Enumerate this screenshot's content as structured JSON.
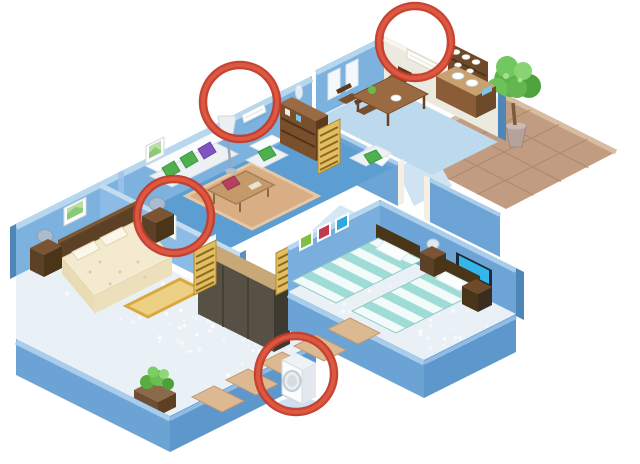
{
  "scene": {
    "type": "isometric-apartment-floorplan",
    "background": "#ffffff",
    "description_id": "aircon-placement-illustration"
  },
  "palette": {
    "wall_blue": "#7db2df",
    "wall_mid": "#6da4d6",
    "wall_shadow": "#5d97cb",
    "wall_top": "#b7d7ef",
    "wall_cap": "#4f86b8",
    "wall_cream": "#ece9df",
    "floor_living": "#5c9ed2",
    "floor_kitchen": "#bcd9ee",
    "floor_hall": "#cfe3f2",
    "carpet": "#e9f0f6",
    "terrace": "#c29c80",
    "terrace_line": "#a98566",
    "tile_path": "#dcb991",
    "wood_dark": "#5d4126",
    "wood_mid": "#8a5d38",
    "wood_tan": "#c9a878",
    "quilt_cream": "#f3ead0",
    "stripe_teal": "#9fdcd6",
    "stripe_white": "#f2fbfa",
    "cushion_green": "#4db14e",
    "cushion_purple": "#8055c1",
    "cushion_red": "#b5415f",
    "rug_yellow": "#edd083",
    "leaf_green": "#5cb34a",
    "ac_white": "#fdfefe"
  },
  "annotations": {
    "highlight_stroke_outer": "#c23b2a",
    "highlight_stroke_inner": "#e05a43",
    "circles": [
      {
        "id": "living-room-wall-ac",
        "cx": 240,
        "cy": 102,
        "r": 37
      },
      {
        "id": "kitchen-wall-ac",
        "cx": 415,
        "cy": 42,
        "r": 36
      },
      {
        "id": "master-bedroom-wall-ac",
        "cx": 174,
        "cy": 216,
        "r": 37
      },
      {
        "id": "outdoor-condenser-unit",
        "cx": 296,
        "cy": 374,
        "r": 38
      }
    ]
  },
  "inventory": {
    "rooms": [
      "living-room",
      "kitchen-dining",
      "master-bedroom",
      "twin-bedroom",
      "hallway",
      "terrace"
    ],
    "highlighted_equipment": [
      "living-room-wall-ac",
      "kitchen-wall-ac",
      "master-bedroom-wall-ac",
      "outdoor-condenser-unit"
    ]
  }
}
